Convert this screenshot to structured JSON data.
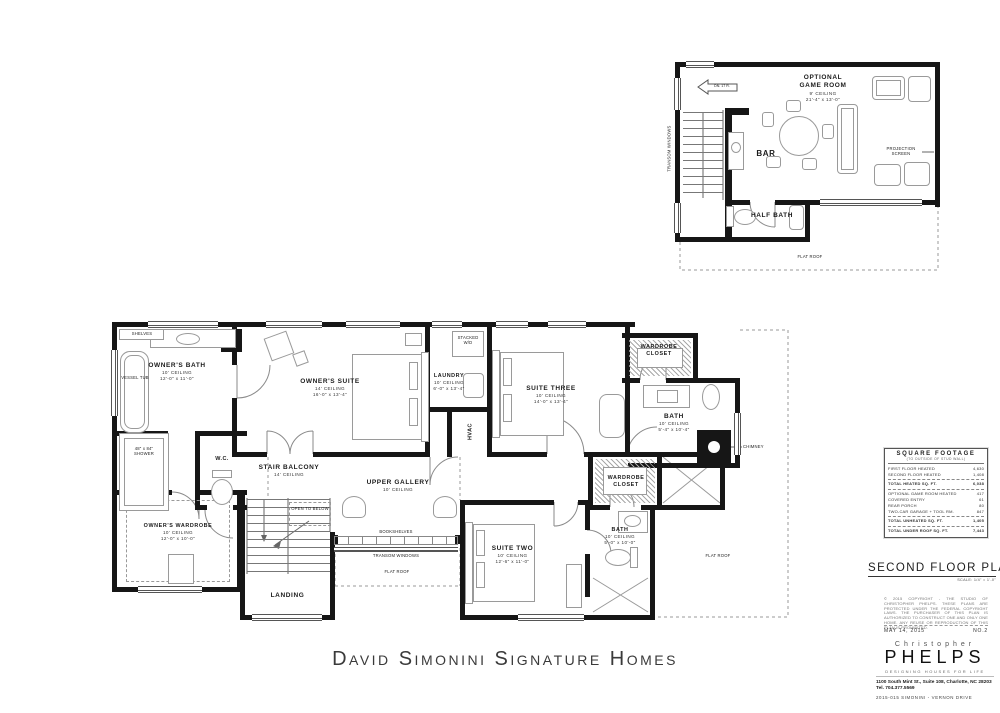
{
  "sheet": {
    "project_title": "David Simonini Signature Homes"
  },
  "rooms": {
    "owners_bath": {
      "name": "OWNER'S BATH",
      "ceiling": "10' CEILING",
      "dims": "12'-0\" x 11'-0\""
    },
    "owners_suite": {
      "name": "OWNER'S SUITE",
      "ceiling": "14' CEILING",
      "dims": "16'-0\" x 13'-4\""
    },
    "laundry": {
      "name": "LAUNDRY",
      "ceiling": "10' CEILING",
      "dims": "6'-0\" x 13'-4\""
    },
    "suite_three": {
      "name": "SUITE THREE",
      "ceiling": "10' CEILING",
      "dims": "14'-0\" x 13'-4\""
    },
    "wardrobe_closet_upper": {
      "name": "WARDROBE CLOSET"
    },
    "bath_upper": {
      "name": "BATH",
      "ceiling": "10' CEILING",
      "dims": "5'-4\" x 10'-4\""
    },
    "stair_balcony": {
      "name": "STAIR BALCONY",
      "ceiling": "14' CEILING"
    },
    "upper_gallery": {
      "name": "UPPER GALLERY",
      "ceiling": "10' CEILING"
    },
    "owners_wardrobe": {
      "name": "OWNER'S WARDROBE",
      "ceiling": "10' CEILING",
      "dims": "12'-0\" x 10'-0\""
    },
    "landing": {
      "name": "LANDING"
    },
    "suite_two": {
      "name": "SUITE TWO",
      "ceiling": "10' CEILING",
      "dims": "12'-6\" x 11'-0\""
    },
    "wardrobe_closet_lower": {
      "name": "WARDROBE CLOSET"
    },
    "bath_lower": {
      "name": "BATH",
      "ceiling": "10' CEILING",
      "dims": "5'-0\" x 10'-0\""
    },
    "wc": {
      "name": "W.C."
    },
    "hvac": {
      "name": "HVAC"
    },
    "game_room": {
      "name": "OPTIONAL GAME ROOM",
      "ceiling": "9' CEILING",
      "dims": "21'-4\" x 13'-0\""
    },
    "bar": {
      "name": "BAR"
    },
    "half_bath": {
      "name": "HALF BATH"
    }
  },
  "labels": {
    "shelves": "SHELVES",
    "vessel_tub": "VESSEL TUB",
    "shower_size": "48\" x 84\"",
    "shower": "SHOWER",
    "stacked": "STACKED",
    "wd": "W/D",
    "open_to_below": "OPEN TO BELOW",
    "bookshelves": "BOOKSHELVES",
    "transom_windows": "TRANSOM WINDOWS",
    "flat_roof": "FLAT ROOF",
    "chimney": "CHIMNEY",
    "projection_screen": "PROJECTION SCREEN",
    "dn_note": "DN. 17 R."
  },
  "sqft_table": {
    "title": "SQUARE FOOTAGE",
    "subtitle": "(TO OUTSIDE OF STUD WALL)",
    "rows": [
      {
        "label": "FIRST FLOOR HEATED",
        "value": "4,630"
      },
      {
        "label": "SECOND FLOOR HEATED",
        "value": "1,408"
      },
      {
        "label": "TOTAL HEATED SQ. FT.",
        "value": "6,038"
      },
      {
        "label": "OPTIONAL GAME ROOM HEATED",
        "value": "417"
      },
      {
        "label": "COVERED ENTRY",
        "value": "61"
      },
      {
        "label": "REAR PORCH",
        "value": "80"
      },
      {
        "label": "TWO-CAR GARAGE + TOOL RM.",
        "value": "847"
      },
      {
        "label": "TOTAL UNHEATED SQ. FT.",
        "value": "1,405"
      },
      {
        "label": "TOTAL UNDER ROOF SQ. FT.",
        "value": "7,443"
      }
    ]
  },
  "title_block": {
    "plan_title": "SECOND FLOOR PLAN",
    "scale": "SCALE: 1/4\" = 1'-0\"",
    "copyright": "© 2015 COPYRIGHT - THE STUDIO OF CHRISTOPHER PHELPS. THESE PLANS ARE PROTECTED UNDER THE FEDERAL COPYRIGHT LAWS. THE PURCHASER OF THIS PLAN IS AUTHORIZED TO CONSTRUCT ONE AND ONLY ONE HOME. ANY REUSE OR REPRODUCTION OF THIS PLAN IS PROHIBITED.",
    "date": "MAY 14, 2015",
    "sheet_no": "NO.2"
  },
  "logo": {
    "first_name": "Christopher",
    "last_name": "PHELPS",
    "tagline": "DESIGNING HOUSES FOR LIFE",
    "address": "1100 South Mint St., Suite 108, Charlotte, NC 28203",
    "phone": "Tel. 704.377.5569",
    "job": "2015-015   SIMONINI - VERNON DRIVE"
  }
}
